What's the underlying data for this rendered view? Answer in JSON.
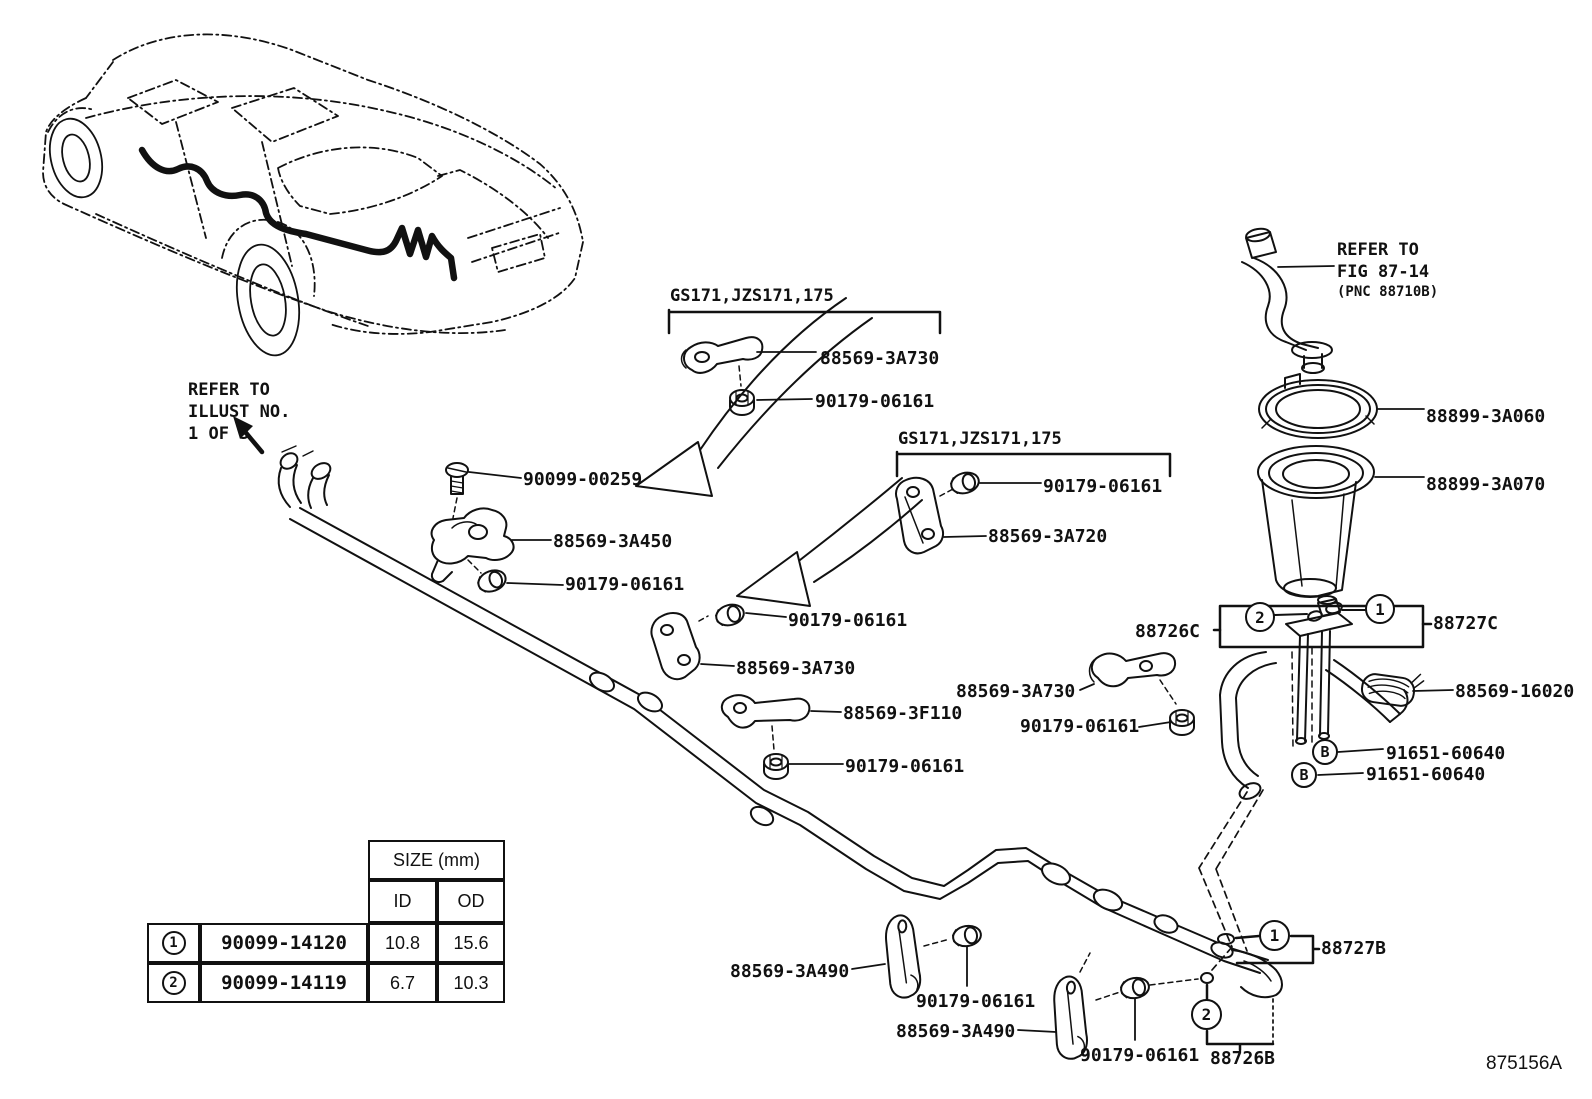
{
  "page": {
    "figure_code": "875156A"
  },
  "notes": {
    "illust": [
      "REFER TO",
      "ILLUST NO.",
      "1 OF 3"
    ],
    "fig": [
      "REFER TO",
      "FIG 87-14",
      "(PNC 88710B)"
    ]
  },
  "group_labels": [
    {
      "text": "GS171,JZS171,175"
    },
    {
      "text": "GS171,JZS171,175"
    }
  ],
  "callouts": [
    {
      "part_number": "88569-3A730"
    },
    {
      "part_number": "90179-06161"
    },
    {
      "part_number": "90099-00259"
    },
    {
      "part_number": "88569-3A450"
    },
    {
      "part_number": "90179-06161"
    },
    {
      "part_number": "90179-06161"
    },
    {
      "part_number": "88569-3A720"
    },
    {
      "part_number": "90179-06161"
    },
    {
      "part_number": "88569-3A730"
    },
    {
      "part_number": "88569-3F110"
    },
    {
      "part_number": "90179-06161"
    },
    {
      "part_number": "88569-3A730"
    },
    {
      "part_number": "90179-06161"
    },
    {
      "part_number": "88899-3A060"
    },
    {
      "part_number": "88899-3A070"
    },
    {
      "part_number": "88726C"
    },
    {
      "part_number": "88727C"
    },
    {
      "part_number": "88569-16020"
    },
    {
      "part_number": "91651-60640"
    },
    {
      "part_number": "91651-60640"
    },
    {
      "part_number": "88569-3A490"
    },
    {
      "part_number": "90179-06161"
    },
    {
      "part_number": "88569-3A490"
    },
    {
      "part_number": "90179-06161"
    },
    {
      "part_number": "88726B"
    },
    {
      "part_number": "88727B"
    }
  ],
  "ref_markers": {
    "circle_1": "1",
    "circle_2": "2",
    "circle_b": "B"
  },
  "size_table": {
    "title": "SIZE (mm)",
    "columns": [
      "ID",
      "OD"
    ],
    "rows": [
      {
        "ref": "1",
        "part_number": "90099-14120",
        "id_mm": "10.8",
        "od_mm": "15.6"
      },
      {
        "ref": "2",
        "part_number": "90099-14119",
        "id_mm": "6.7",
        "od_mm": "10.3"
      }
    ]
  }
}
